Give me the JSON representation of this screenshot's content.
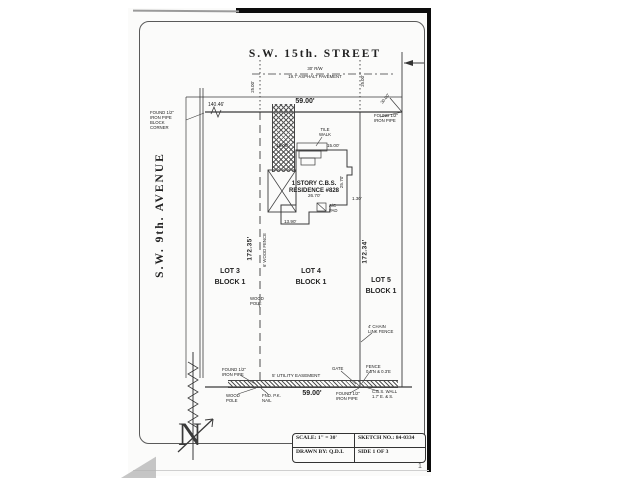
{
  "header": {
    "street": "S.W. 15th. STREET",
    "street_rw": "30' R/W",
    "street_pavement": "19.7' ASPHALT PAVEMENT",
    "avenue": "S.W. 9th. AVENUE"
  },
  "lots": {
    "lot3": {
      "name": "LOT 3",
      "block": "BLOCK 1"
    },
    "lot4": {
      "name": "LOT 4",
      "block": "BLOCK 1"
    },
    "lot5": {
      "name": "LOT 5",
      "block": "BLOCK 1"
    }
  },
  "residence": {
    "line1": "1 STORY C.B.S.",
    "line2": "RESIDENCE #828"
  },
  "dims": {
    "front_width": "59.00'",
    "rear_width": "59.00'",
    "west_depth": "172.35'",
    "east_depth": "172.34'",
    "block_tie": "140.46'",
    "rw_left": "25.00'",
    "rw_right": "25.00'",
    "corner_tie": "30.00'",
    "house_front_left": "15.00'",
    "house_front_right": "15.00'",
    "house_side": "25.70'",
    "house_rear": "26.70'",
    "house_wing": "13.90'",
    "offset": "1.30'"
  },
  "markers": {
    "nw": [
      "FOUND 1/2\"",
      "IRON PIPE",
      "BLOCK",
      "CORNER"
    ],
    "ne": [
      "FOUND 1/2\"",
      "IRON PIPE"
    ],
    "sw": [
      "FOUND 1/2\"",
      "IRON PIPE"
    ],
    "sw_pole": [
      "WOOD",
      "POLE"
    ],
    "sw_nail": [
      "FND. P.K.",
      "NAIL"
    ],
    "se": [
      "FOUND 1/2\"",
      "IRON PIPE"
    ],
    "se_wall": [
      "C.B.S. WALL",
      "1.7' E. & S."
    ],
    "se_fence": [
      "FENCE",
      "0.3'N & 0.3'E"
    ],
    "se_gate": "GATE"
  },
  "features": {
    "tile_walk": [
      "TILE",
      "WALK"
    ],
    "wood_pole": [
      "WOOD",
      "POLE"
    ],
    "wood_fence": "6' WOOD FENCE",
    "chain_fence": [
      "4' CHAIN",
      "LINK FENCE"
    ],
    "easement": "5' UTILITY EASEMENT",
    "ac_pad": [
      "A/C",
      "PAD"
    ]
  },
  "title_block": {
    "scale": "SCALE: 1\" = 30'",
    "sketch_no": "SKETCH NO.: 84-0334",
    "drawn_by": "DRAWN BY: Q.D.I.",
    "side": "SIDE 1 OF 3"
  },
  "compass": {
    "letter": "N"
  },
  "page": {
    "artifact_mark": "1"
  }
}
